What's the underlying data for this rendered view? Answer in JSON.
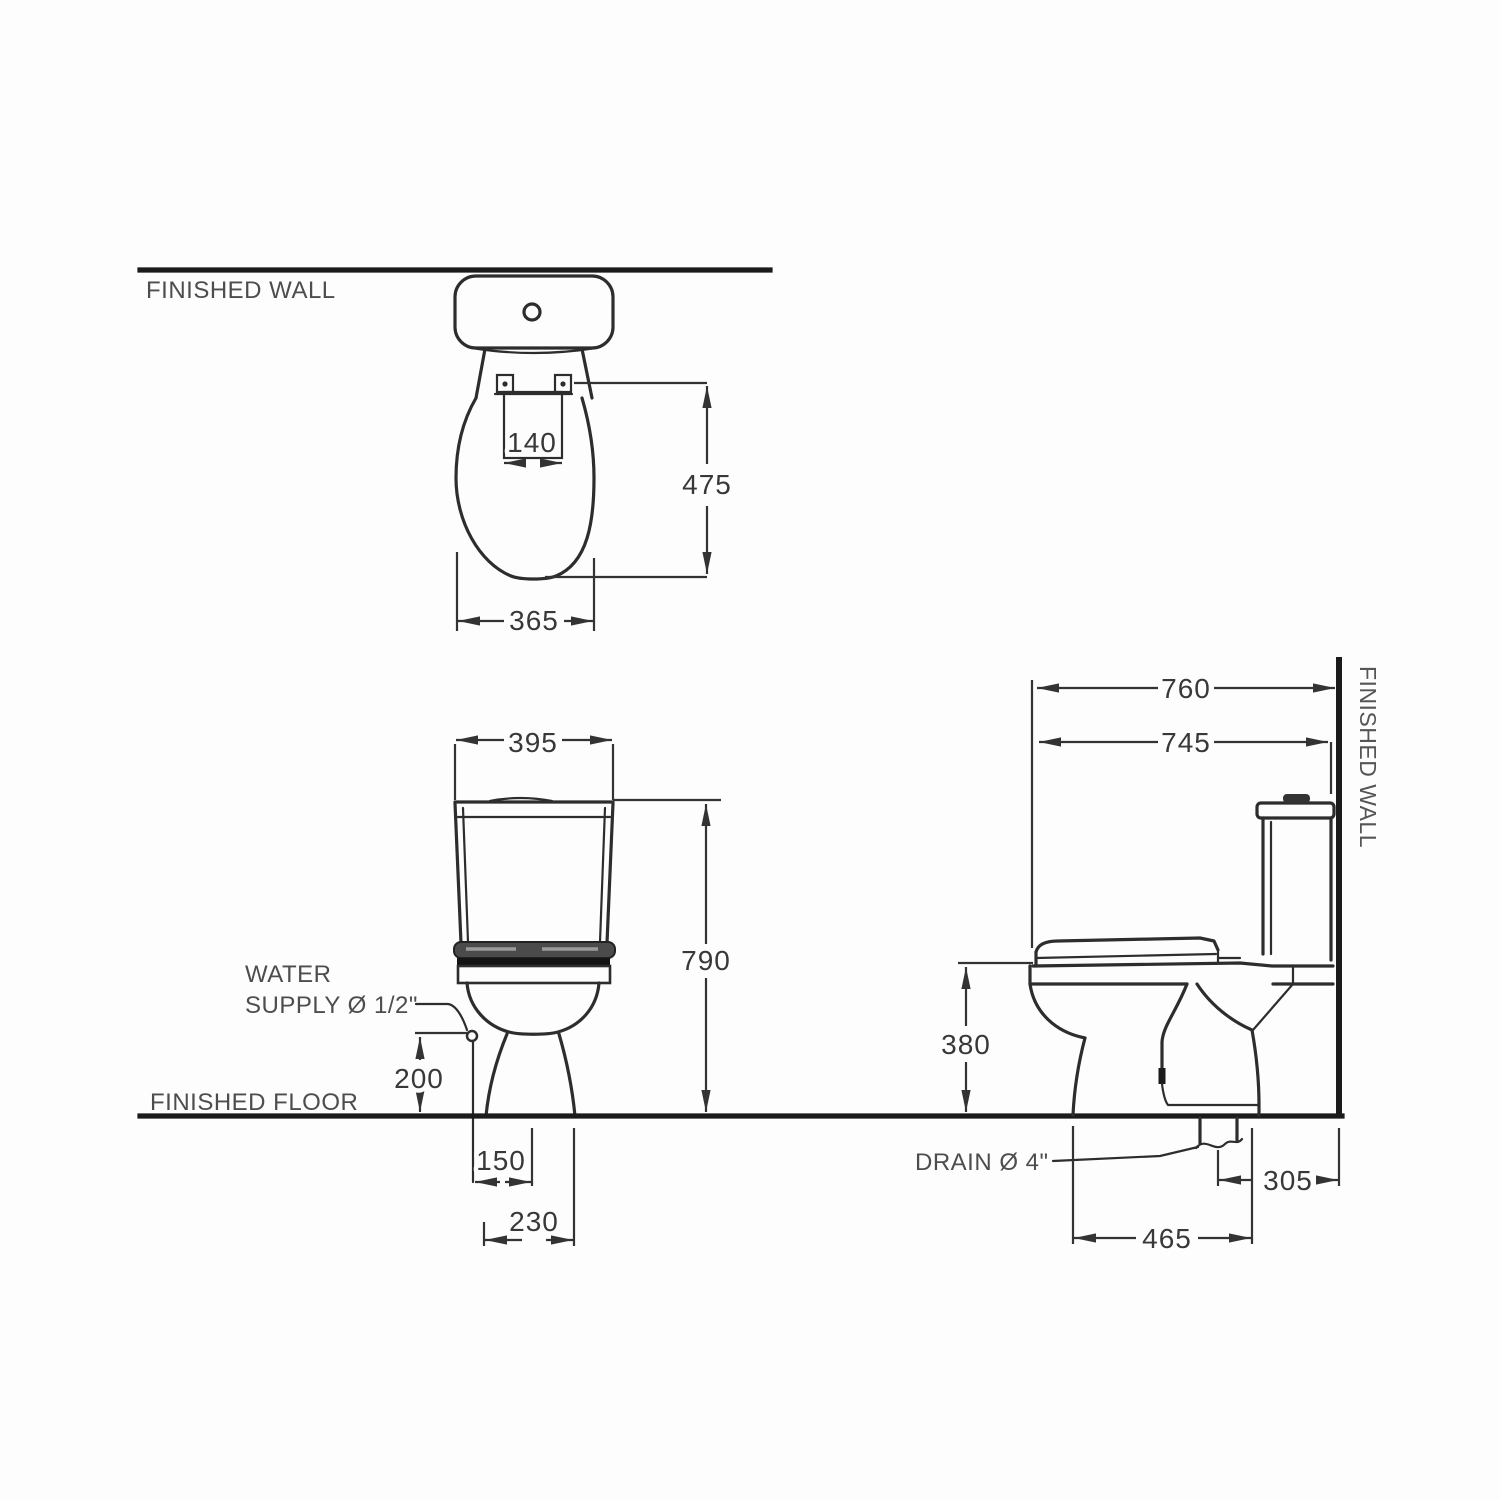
{
  "drawing_type": "toilet installation dimension drawing",
  "colors": {
    "background": "#fdfdfd",
    "line": "#2d2d2d",
    "structural_line": "#1b1b1b",
    "label_text": "#4d4d4d",
    "dimension_text": "#383838"
  },
  "labels": {
    "finished_wall": "FINISHED WALL",
    "finished_floor": "FINISHED FLOOR",
    "water_supply_1": "WATER",
    "water_supply_2": "SUPPLY Ø 1/2\"",
    "drain": "DRAIN Ø 4\""
  },
  "dims": {
    "top": {
      "hinge_width": "140",
      "length": "475",
      "width": "365"
    },
    "front": {
      "tank_width": "395",
      "overall_height": "790",
      "supply_height": "200",
      "supply_offset": "150",
      "base_width": "230"
    },
    "side": {
      "overall_depth": "760",
      "lid_depth": "745",
      "rim_height": "380",
      "drain_to_wall": "305",
      "base_depth": "465"
    }
  }
}
